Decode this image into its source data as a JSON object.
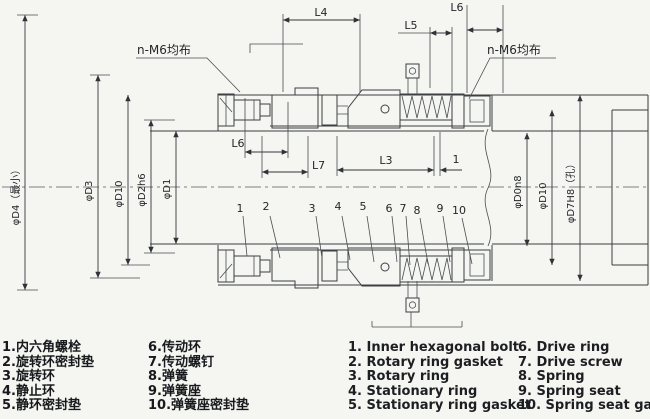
{
  "drawing": {
    "notes": {
      "left_screws": "n-M6均布",
      "right_screws": "n-M6均布"
    },
    "dims": {
      "L4": "L4",
      "L5": "L5",
      "L6_top": "L6",
      "L6_mid": "L6",
      "L7": "L7",
      "L3": "L3",
      "gap": "1",
      "d4": "φD4（最小）",
      "d3": "φD3",
      "d10_left": "φD10",
      "d2": "φD2h6",
      "d1": "φD1",
      "d0": "φD0n8",
      "d10_right": "φD10",
      "d7": "φD7H8（孔）"
    },
    "callouts": [
      "1",
      "2",
      "3",
      "4",
      "5",
      "6",
      "7",
      "8",
      "9",
      "10"
    ]
  },
  "legend": {
    "zh": [
      "1.内六角螺栓",
      "2.旋转环密封垫",
      "3.旋转环",
      "4.静止环",
      "5.静环密封垫",
      "6.传动环",
      "7.传动螺钉",
      "8.弹簧",
      "9.弹簧座",
      "10.弹簧座密封垫"
    ],
    "en": [
      "1. Inner hexagonal bolt",
      "2. Rotary ring gasket",
      "3. Rotary ring",
      "4. Stationary ring",
      "5. Stationary ring gasket",
      "6. Drive ring",
      "7. Drive screw",
      "8. Spring",
      "9. Spring seat",
      "10. Spring seat gasket"
    ]
  },
  "colors": {
    "ink": "#3c3f44",
    "paper": "#f5f5f1"
  }
}
